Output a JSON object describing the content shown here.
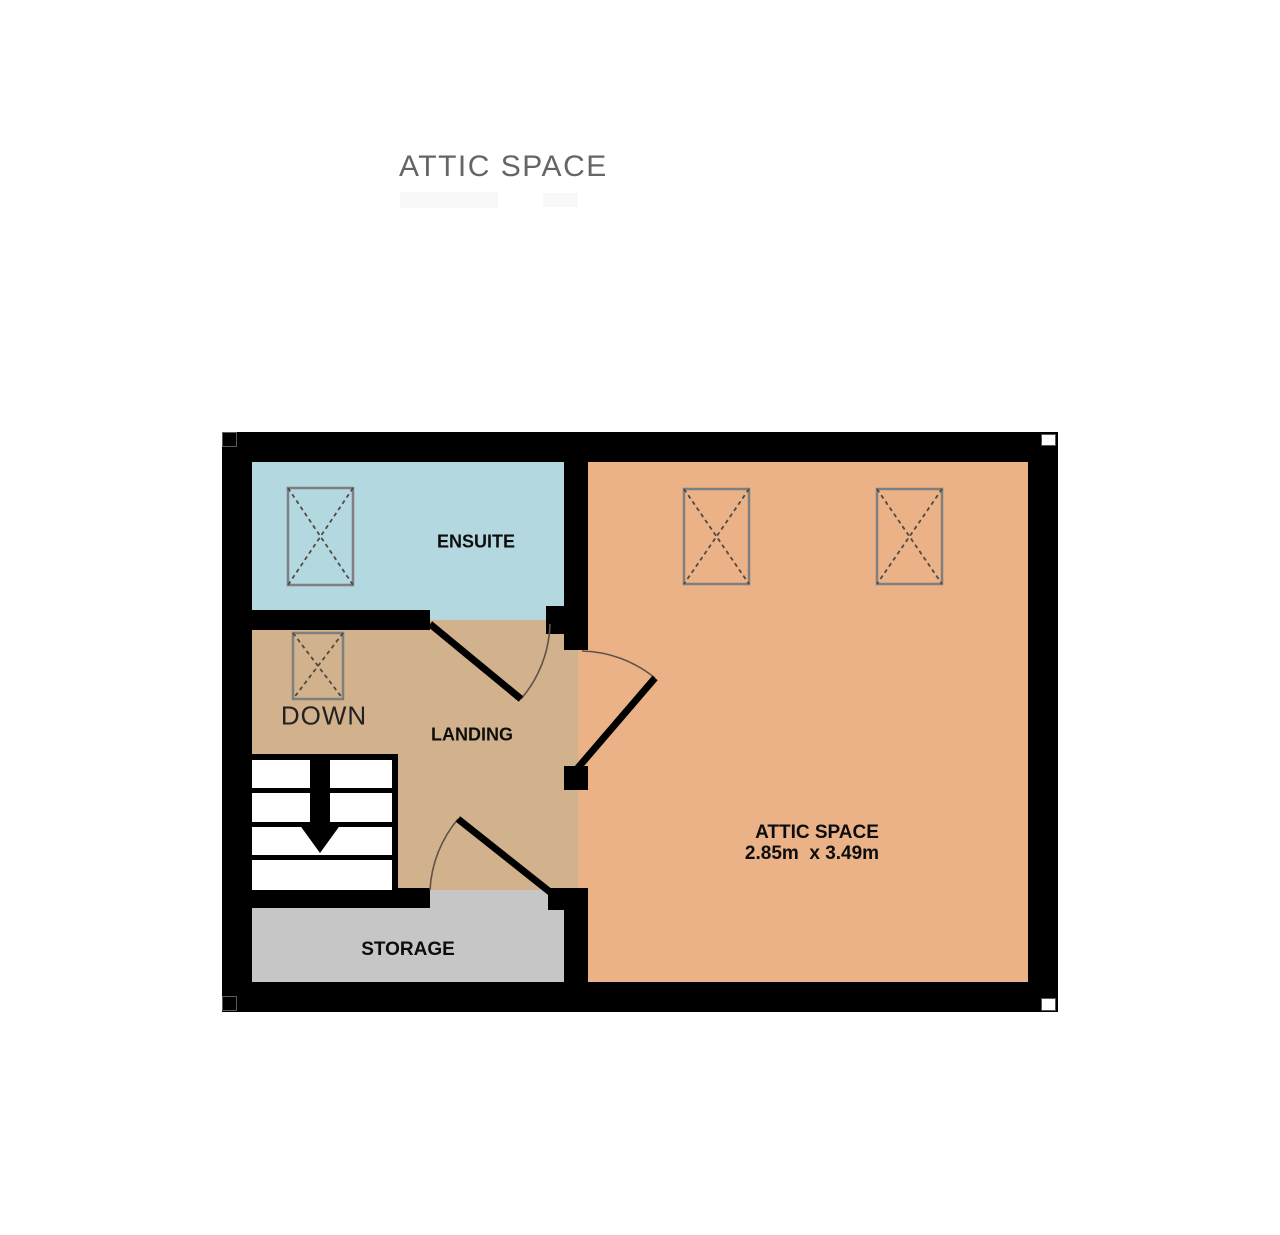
{
  "page": {
    "title": "ATTIC SPACE"
  },
  "plan": {
    "wall_color": "#000000",
    "rooms": [
      {
        "id": "ensuite",
        "label": "ENSUITE",
        "color": "#b4d8e0"
      },
      {
        "id": "landing",
        "label": "LANDING",
        "color": "#d1b28c"
      },
      {
        "id": "attic",
        "label": "ATTIC SPACE",
        "dimensions": "2.85m  x 3.49m",
        "color": "#eab286"
      },
      {
        "id": "storage",
        "label": "STORAGE",
        "color": "#c6c6c6"
      }
    ],
    "stairs": {
      "direction_label": "DOWN",
      "treads": 4
    },
    "symbols": {
      "skylight_count": 4,
      "door_count": 3
    }
  }
}
